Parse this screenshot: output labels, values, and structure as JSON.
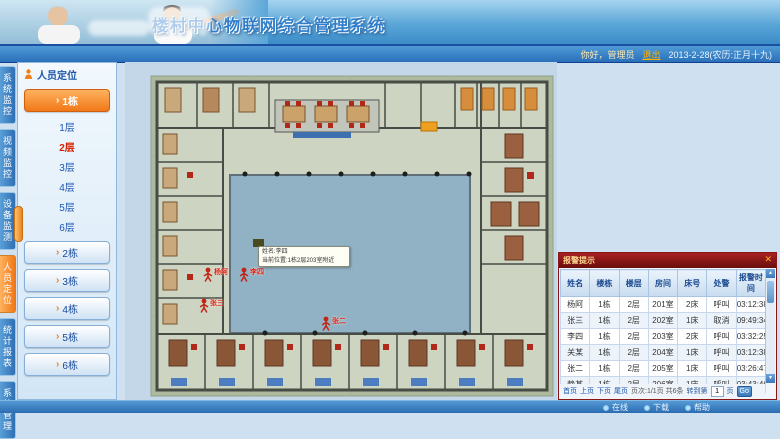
{
  "app": {
    "title": "楼村中心物联网综合管理系统"
  },
  "topbar": {
    "greeting": "你好，管理员",
    "logout_label": "退出",
    "date": "2013-2-28(农历:正月十九)"
  },
  "nav_tabs": [
    {
      "label": "系统监控",
      "active": false
    },
    {
      "label": "视频监控",
      "active": false
    },
    {
      "label": "设备监测",
      "active": false
    },
    {
      "label": "人员定位",
      "active": true
    },
    {
      "label": "统计报表",
      "active": false
    },
    {
      "label": "系统管理",
      "active": false
    }
  ],
  "sidebar": {
    "title": "人员定位",
    "active_building": "1栋",
    "floors": [
      {
        "label": "1层",
        "current": false
      },
      {
        "label": "2层",
        "current": true
      },
      {
        "label": "3层",
        "current": false
      },
      {
        "label": "4层",
        "current": false
      },
      {
        "label": "5层",
        "current": false
      },
      {
        "label": "6层",
        "current": false
      }
    ],
    "buildings": [
      "2栋",
      "3栋",
      "4栋",
      "5栋",
      "6栋"
    ]
  },
  "floorplan": {
    "tooltip": {
      "line1": "姓名:李四",
      "line2": "当前位置:1栋2层203室附近"
    },
    "markers": [
      {
        "name": "杨阿",
        "x": 78,
        "y": 205
      },
      {
        "name": "李四",
        "x": 114,
        "y": 205
      },
      {
        "name": "张三",
        "x": 74,
        "y": 236
      },
      {
        "name": "张二",
        "x": 196,
        "y": 254
      }
    ]
  },
  "alarm_panel": {
    "title": "报警提示",
    "columns": [
      "姓名",
      "楼栋",
      "楼层",
      "房间",
      "床号",
      "处警",
      "报警时间"
    ],
    "rows": [
      [
        "杨阿",
        "1栋",
        "2层",
        "201室",
        "2床",
        "呼叫",
        "03:12:38"
      ],
      [
        "张三",
        "1栋",
        "2层",
        "202室",
        "1床",
        "取消",
        "09:49:34"
      ],
      [
        "李四",
        "1栋",
        "2层",
        "203室",
        "2床",
        "呼叫",
        "03:32:25"
      ],
      [
        "关某",
        "1栋",
        "2层",
        "204室",
        "1床",
        "呼叫",
        "03:12:38"
      ],
      [
        "张二",
        "1栋",
        "2层",
        "205室",
        "1床",
        "呼叫",
        "03:26:47"
      ],
      [
        "静某",
        "1栋",
        "2层",
        "206室",
        "1床",
        "呼叫",
        "03:43:46"
      ]
    ],
    "pagination": {
      "links": [
        "首页",
        "上页",
        "下页",
        "尾页"
      ],
      "info": "页次:1/1页 共6条",
      "goto_prefix": "转到第",
      "goto_value": "1",
      "goto_suffix": "页",
      "go_label": "Go"
    }
  },
  "statusbar": {
    "items": [
      "在线",
      "下载",
      "帮助"
    ]
  },
  "colors": {
    "accent_orange": "#f07818",
    "alarm_header_red": "#8a1515",
    "link_blue": "#1a55b0",
    "current_floor_red": "#d42000",
    "courtyard_blue": "#91b2c4",
    "plan_green": "#aeba9e"
  }
}
